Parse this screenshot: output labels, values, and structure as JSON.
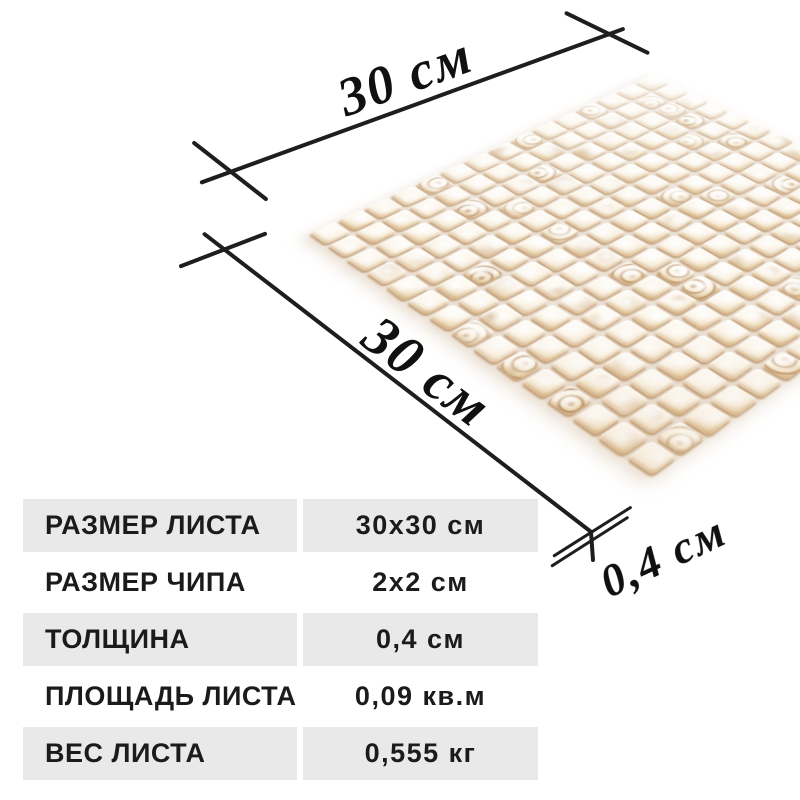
{
  "product": {
    "specs": [
      {
        "label": "РАЗМЕР ЛИСТА",
        "value": "30x30 см"
      },
      {
        "label": "РАЗМЕР ЧИПА",
        "value": "2x2 см"
      },
      {
        "label": "ТОЛЩИНА",
        "value": "0,4 см"
      },
      {
        "label": "ПЛОЩАДЬ ЛИСТА",
        "value": "0,09 кв.м"
      },
      {
        "label": "ВЕС ЛИСТА",
        "value": "0,555 кг"
      }
    ]
  },
  "dimensions": {
    "width_label": "30 см",
    "depth_label": "30 см",
    "thickness_label": "0,4 см"
  },
  "mosaic": {
    "rows": 15,
    "cols": 15,
    "palette": {
      "tile_light": "#fffefb",
      "tile_mid": "#fcf6ea",
      "tile_edge_tints": [
        "#f0e2c8",
        "#ecd7b2",
        "#f6ead6",
        "#e7d0a6"
      ],
      "swirl": "#97612a",
      "grout_shadow": "#a3703a"
    }
  },
  "colors": {
    "background": "#ffffff",
    "table_row_gray": "#e9e9e9",
    "text": "#1b1b1b",
    "line": "#1e1e1e"
  }
}
